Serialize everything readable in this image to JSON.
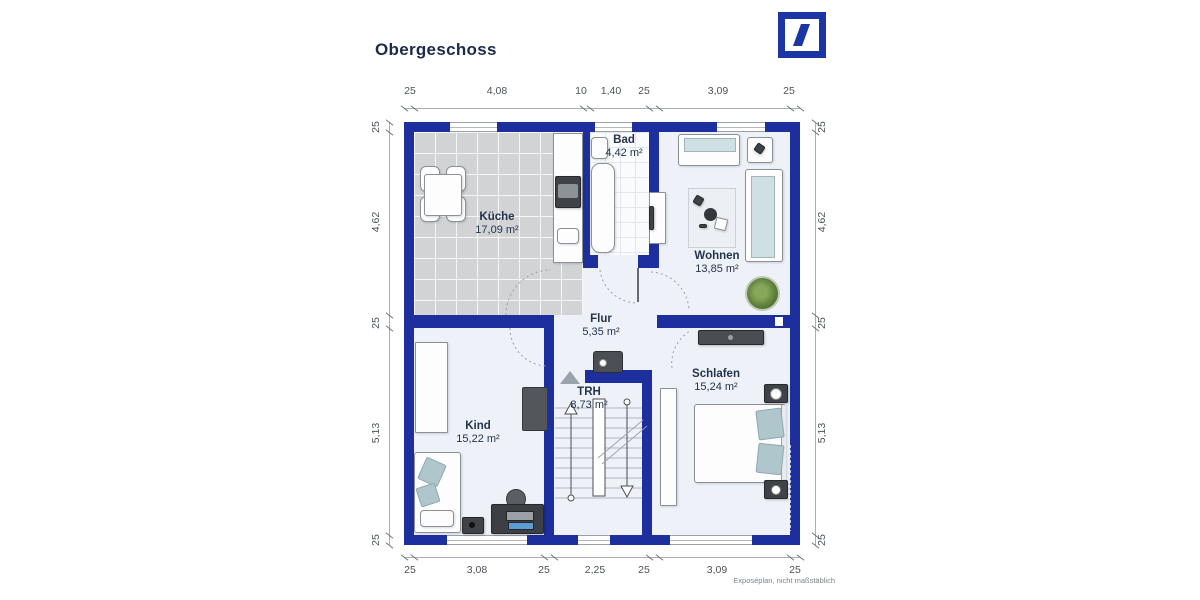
{
  "header": {
    "title": "Obergeschoss"
  },
  "logo": {
    "name": "deutsche-bank-logo",
    "color": "#1C35A5"
  },
  "footnote": "Exposéplan, nicht maßstäblich",
  "colors": {
    "wall": "#1D2F9C",
    "floor": "#EEF2F8",
    "kitchen_tile": "#D2D3D5",
    "cushion": "#AFC7CC"
  },
  "rooms": [
    {
      "name": "Küche",
      "area": "17,09 m²",
      "x": 497,
      "y": 211
    },
    {
      "name": "Bad",
      "area": "4,42 m²",
      "x": 624,
      "y": 134
    },
    {
      "name": "Wohnen",
      "area": "13,85 m²",
      "x": 717,
      "y": 250
    },
    {
      "name": "Flur",
      "area": "5,35 m²",
      "x": 601,
      "y": 313
    },
    {
      "name": "TRH",
      "area": "8,73 m²",
      "x": 589,
      "y": 386
    },
    {
      "name": "Kind",
      "area": "15,22 m²",
      "x": 478,
      "y": 420
    },
    {
      "name": "Schlafen",
      "area": "15,24 m²",
      "x": 716,
      "y": 368
    }
  ],
  "dimensions": {
    "top": [
      {
        "label": "25",
        "x": 410
      },
      {
        "label": "4,08",
        "x": 497
      },
      {
        "label": "10",
        "x": 581
      },
      {
        "label": "1,40",
        "x": 611
      },
      {
        "label": "25",
        "x": 644
      },
      {
        "label": "3,09",
        "x": 718
      },
      {
        "label": "25",
        "x": 789
      }
    ],
    "bottom": [
      {
        "label": "25",
        "x": 410
      },
      {
        "label": "3,08",
        "x": 477
      },
      {
        "label": "25",
        "x": 544
      },
      {
        "label": "2,25",
        "x": 595
      },
      {
        "label": "25",
        "x": 644
      },
      {
        "label": "3,09",
        "x": 717
      },
      {
        "label": "25",
        "x": 795
      }
    ],
    "left": [
      {
        "label": "25",
        "y": 127
      },
      {
        "label": "4,62",
        "y": 222
      },
      {
        "label": "25",
        "y": 323
      },
      {
        "label": "5,13",
        "y": 433
      },
      {
        "label": "25",
        "y": 540
      }
    ],
    "right": [
      {
        "label": "25",
        "y": 127
      },
      {
        "label": "4,62",
        "y": 222
      },
      {
        "label": "25",
        "y": 323
      },
      {
        "label": "5,13",
        "y": 433
      },
      {
        "label": "25",
        "y": 540
      }
    ]
  }
}
